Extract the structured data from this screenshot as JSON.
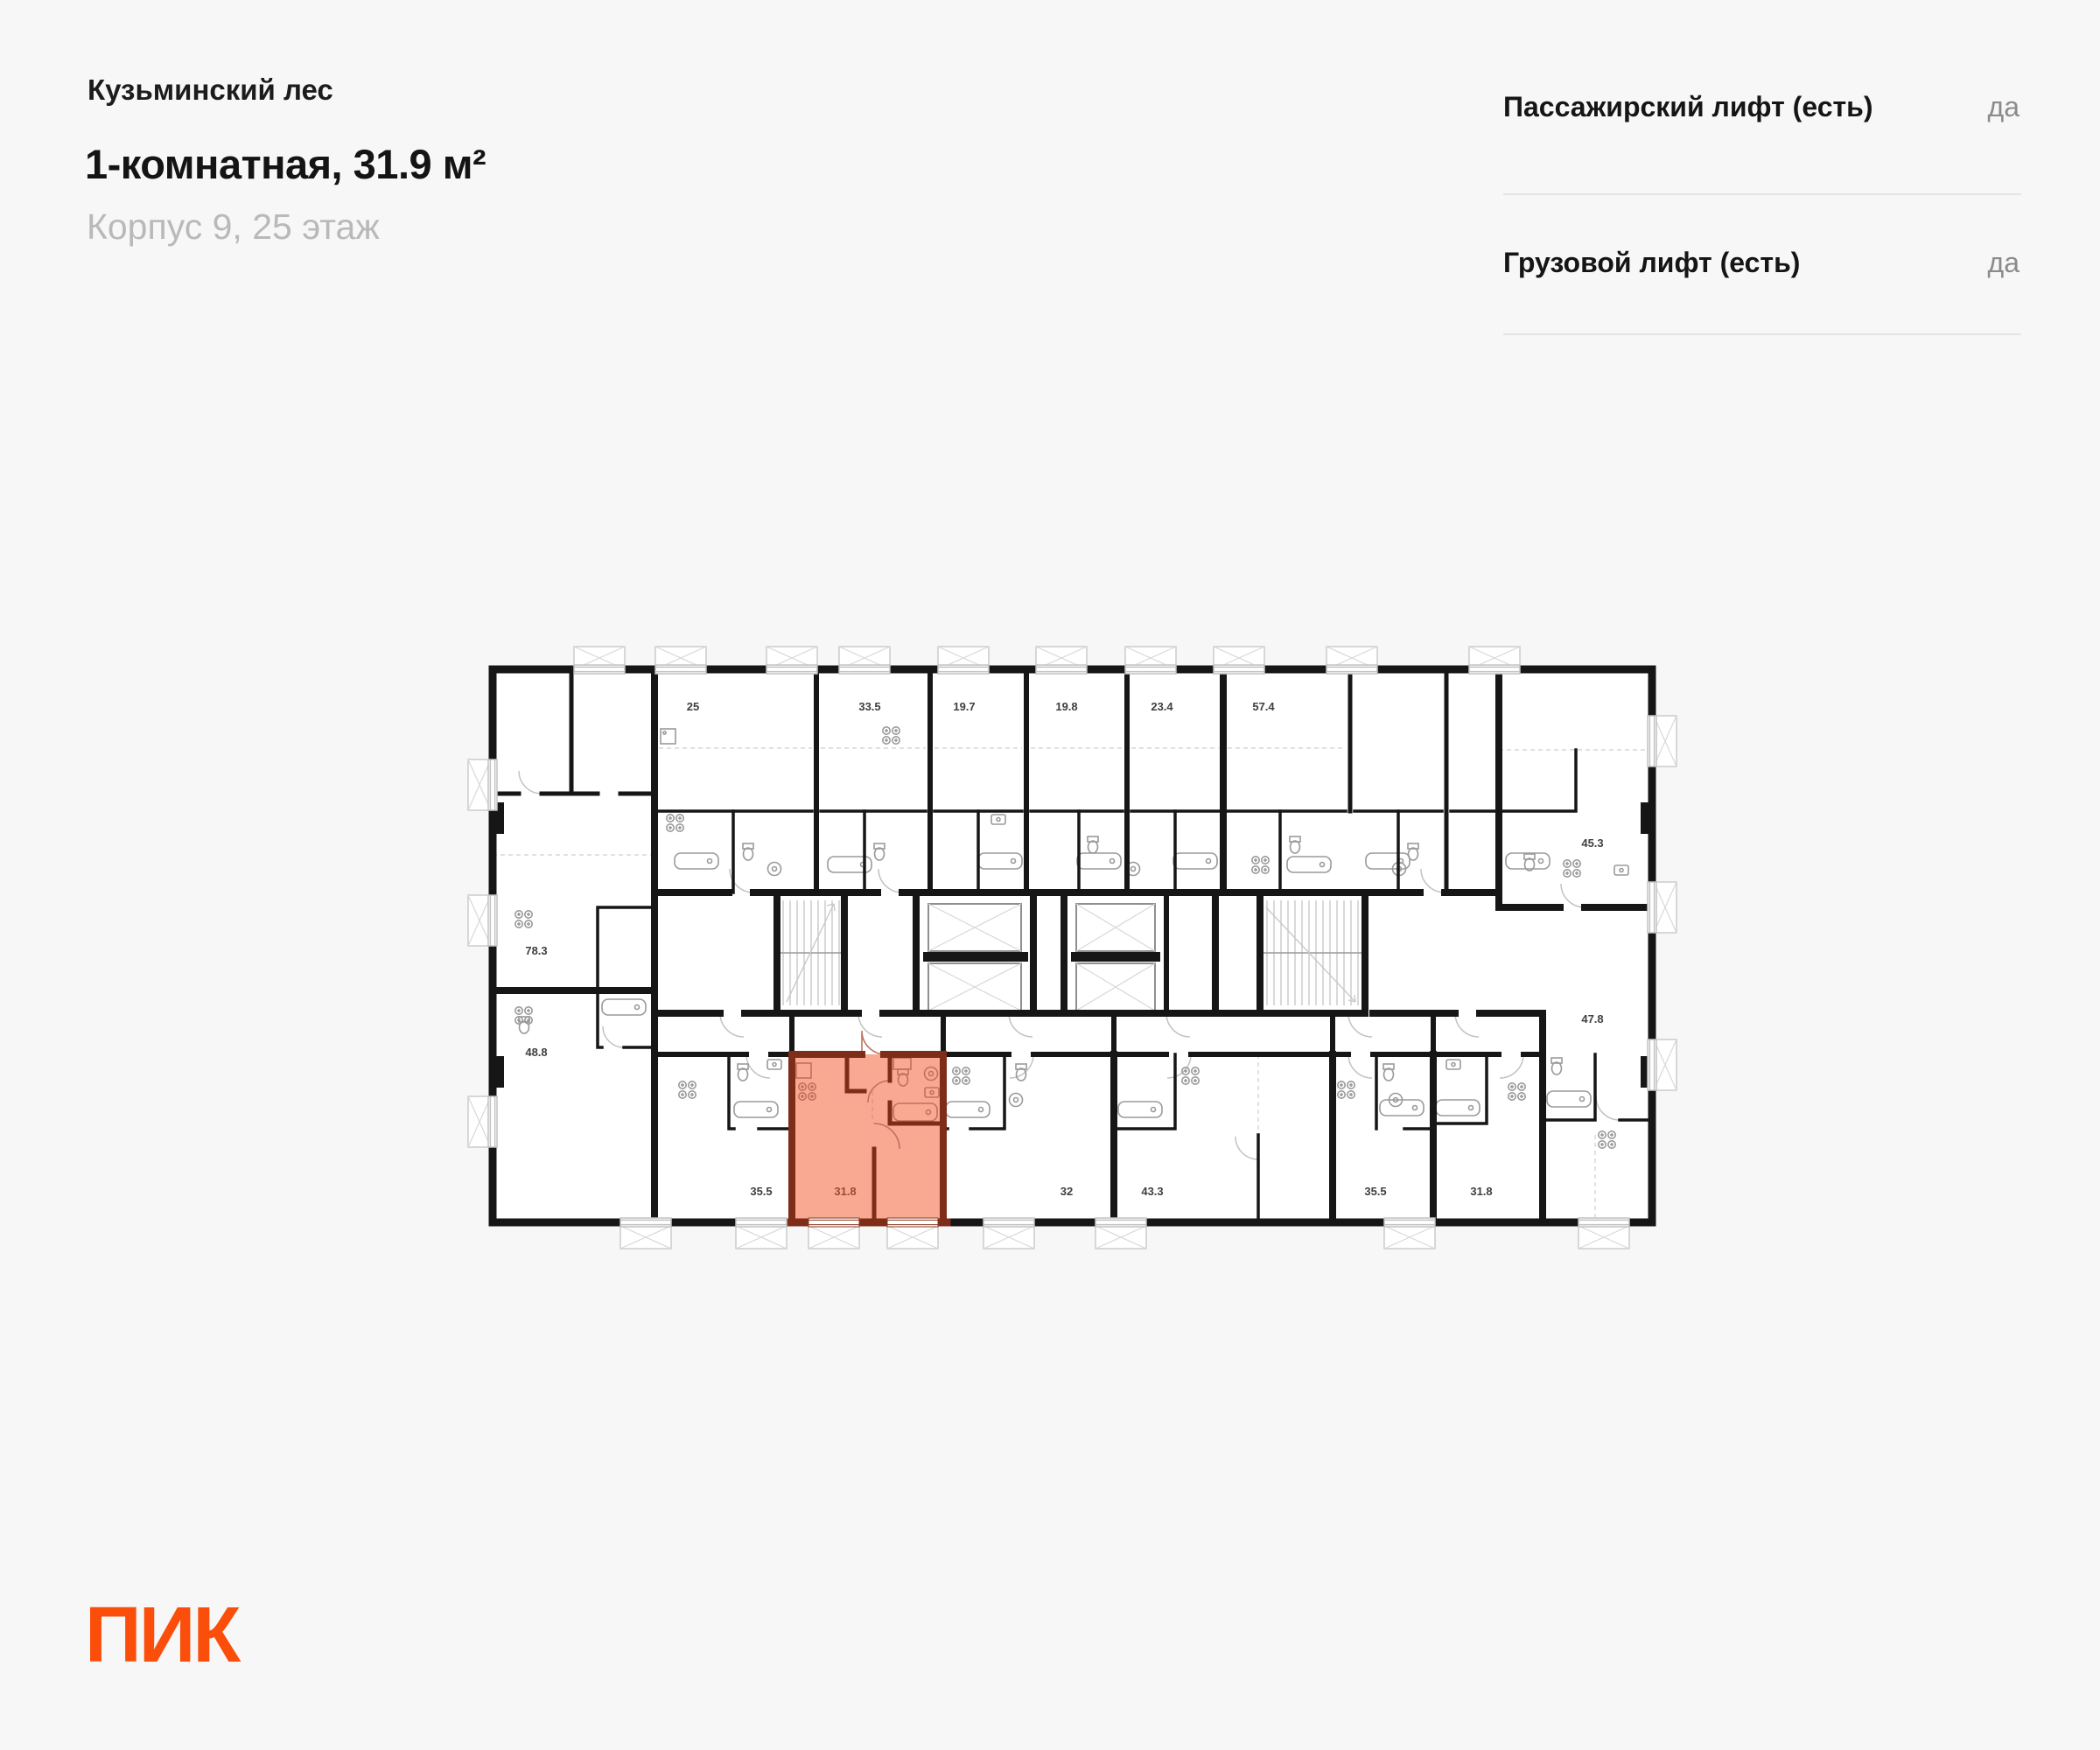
{
  "header": {
    "project": "Кузьминский лес",
    "title": "1-комнатная, 31.9 м²",
    "subtitle": "Корпус 9, 25 этаж"
  },
  "specs": [
    {
      "label": "Пассажирский лифт (есть)",
      "value": "да"
    },
    {
      "label": "Грузовой лифт (есть)",
      "value": "да"
    }
  ],
  "logo": {
    "text": "ПИК",
    "color": "#FB4E0B"
  },
  "plan": {
    "colors": {
      "wall": "#161616",
      "highlight_fill": "#F9A892",
      "highlight_wall": "#7D2D18",
      "highlight_label": "#9C4A33",
      "detail_line": "#C2C2C2",
      "paper": "#FFFFFF"
    },
    "highlighted_unit": {
      "area": "31.8"
    },
    "units": [
      {
        "area": "25",
        "highlighted": false
      },
      {
        "area": "33.5",
        "highlighted": false
      },
      {
        "area": "19.7",
        "highlighted": false
      },
      {
        "area": "19.8",
        "highlighted": false
      },
      {
        "area": "23.4",
        "highlighted": false
      },
      {
        "area": "57.4",
        "highlighted": false
      },
      {
        "area": "45.3",
        "highlighted": false
      },
      {
        "area": "78.3",
        "highlighted": false
      },
      {
        "area": "48.8",
        "highlighted": false
      },
      {
        "area": "35.5",
        "highlighted": false
      },
      {
        "area": "31.8",
        "highlighted": true
      },
      {
        "area": "32",
        "highlighted": false
      },
      {
        "area": "43.3",
        "highlighted": false
      },
      {
        "area": "35.5",
        "highlighted": false
      },
      {
        "area": "31.8",
        "highlighted": false
      },
      {
        "area": "47.8",
        "highlighted": false
      }
    ]
  }
}
